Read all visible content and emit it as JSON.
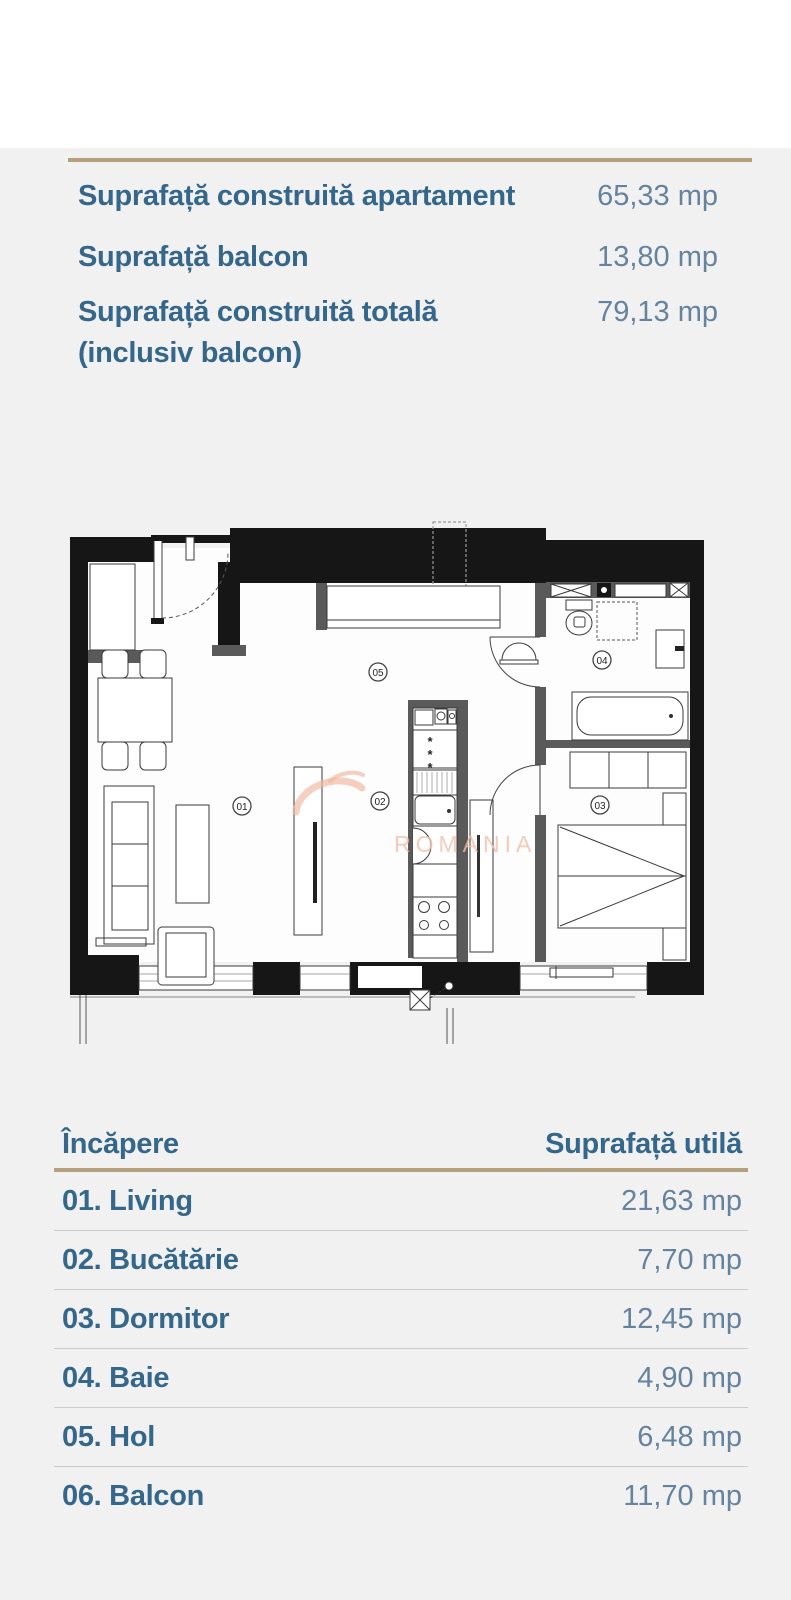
{
  "info": {
    "rows": [
      {
        "label": "Suprafață construită apartament",
        "value": "65,33 mp"
      },
      {
        "label": "Suprafață balcon",
        "value": "13,80 mp"
      },
      {
        "label": "Suprafață construită totală (inclusiv balcon)",
        "value": "79,13 mp"
      }
    ]
  },
  "floorplan": {
    "watermark": "ROMANIA",
    "fridge_marks": [
      "*",
      "*",
      "*"
    ],
    "rooms": [
      {
        "num": "01"
      },
      {
        "num": "02"
      },
      {
        "num": "03"
      },
      {
        "num": "04"
      },
      {
        "num": "05"
      }
    ]
  },
  "table": {
    "headers": {
      "room": "Încăpere",
      "area": "Suprafață utilă"
    },
    "rows": [
      {
        "room": "01. Living",
        "area": "21,63 mp"
      },
      {
        "room": "02. Bucătărie",
        "area": "7,70 mp"
      },
      {
        "room": "03. Dormitor",
        "area": "12,45 mp"
      },
      {
        "room": "04. Baie",
        "area": "4,90 mp"
      },
      {
        "room": "05. Hol",
        "area": "6,48 mp"
      },
      {
        "room": "06. Balcon",
        "area": "11,70 mp"
      }
    ]
  },
  "colors": {
    "accent_line": "#b2a17b",
    "label_blue": "#35678a",
    "value_blue": "#66839e",
    "section_background": "#f1f1f2",
    "watermark_salmon": "#f2bba2"
  }
}
